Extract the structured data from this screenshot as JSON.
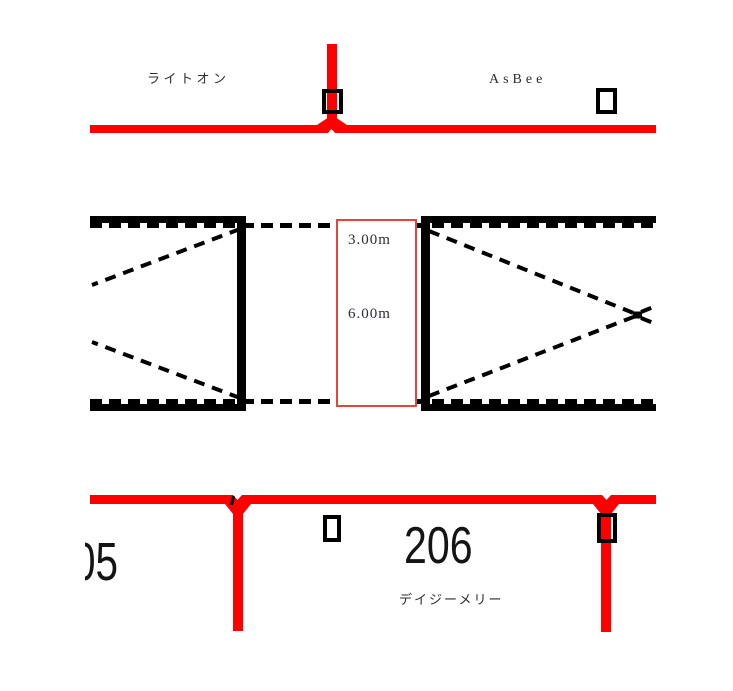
{
  "colors": {
    "road": "#ff0000",
    "linework": "#000000",
    "dimension_border": "#e8423c",
    "label_text": "#2c2c36",
    "number_text": "#141414"
  },
  "labels": {
    "store_top_left": "ライトオン",
    "store_top_right": "AsBee",
    "store_bottom": "デイジーメリー"
  },
  "numbers": {
    "parcel_left_partial": "05",
    "parcel_center": "206"
  },
  "dimension_box": {
    "width_label": "3.00m",
    "length_label": "6.00m"
  },
  "icons": {
    "entrance_marker": "open-rectangle",
    "x_vertex_marker": "bowtie-dot"
  }
}
